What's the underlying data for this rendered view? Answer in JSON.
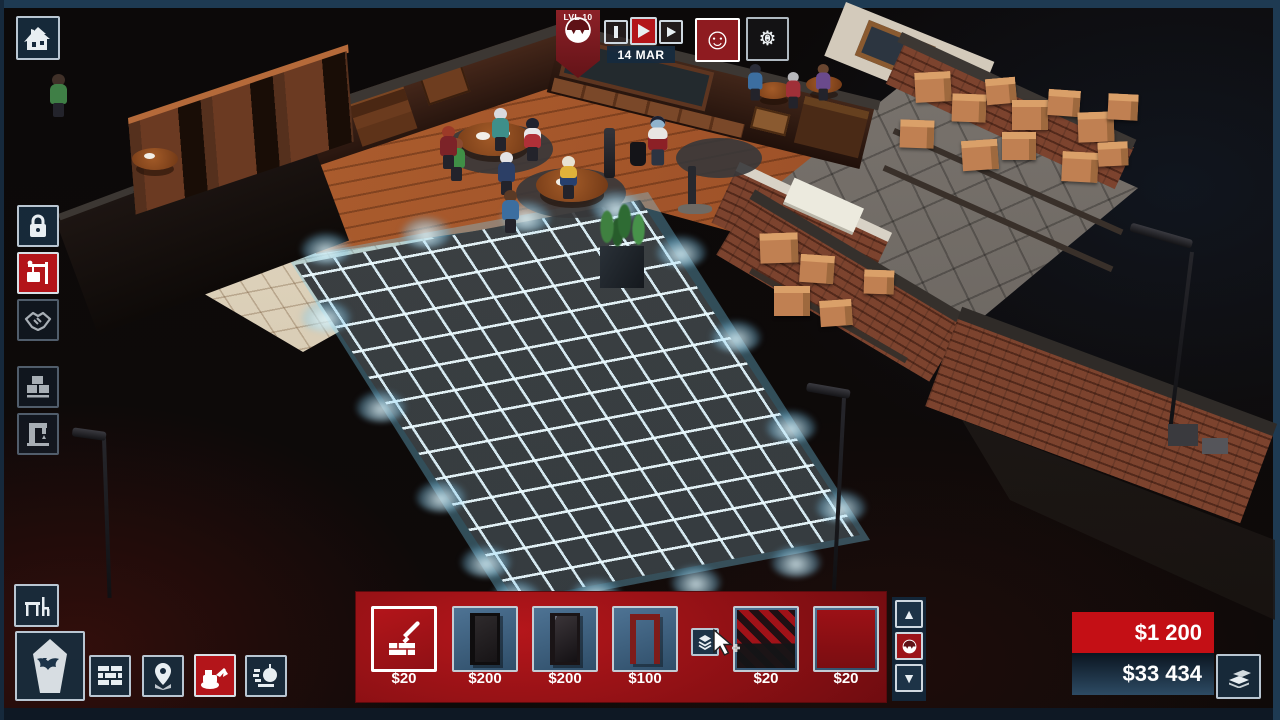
{
  "hud": {
    "level_badge": {
      "label": "LVL 10",
      "icon": "vampire-face-icon"
    },
    "playback": {
      "active": "play",
      "buttons": [
        "pause",
        "play",
        "fast-forward"
      ]
    },
    "date": "14 MAR",
    "mood": {
      "glyph": "☺",
      "icon": "smiley-icon"
    },
    "maintenance": {
      "glyph": "⚙",
      "count": "0",
      "icon": "gear-icon"
    }
  },
  "left_toolbar": {
    "items": [
      {
        "name": "property",
        "icon": "haunted-house-icon"
      },
      {
        "name": "security",
        "icon": "padlock-icon"
      },
      {
        "name": "build",
        "icon": "crane-sign-icon",
        "selected": true
      },
      {
        "name": "deals",
        "icon": "handshake-icon",
        "disabled": true
      },
      {
        "name": "warehouse",
        "icon": "pallet-boxes-icon",
        "disabled": true
      },
      {
        "name": "machines",
        "icon": "drill-press-icon",
        "disabled": true
      }
    ]
  },
  "bottom_toolbar": {
    "items": [
      {
        "name": "furniture",
        "icon": "table-chair-icon"
      },
      {
        "name": "coffin",
        "icon": "coffin-bat-icon"
      },
      {
        "name": "walls",
        "icon": "brick-wall-icon"
      },
      {
        "name": "locations",
        "icon": "map-pin-icon"
      },
      {
        "name": "excavate",
        "icon": "excavator-icon",
        "selected": true
      },
      {
        "name": "demolish",
        "icon": "wrecking-ball-icon"
      }
    ]
  },
  "build_palette": {
    "items": [
      {
        "label": "floor-build-tool",
        "icon": "trowel-bricks-icon",
        "price": "$20",
        "selected": true
      },
      {
        "label": "dark-door",
        "price": "$200"
      },
      {
        "label": "glass-display-door",
        "price": "$200"
      },
      {
        "label": "door-frame",
        "price": "$100"
      },
      {
        "label": "checkered-flooring",
        "price": "$20"
      },
      {
        "label": "red-flooring",
        "price": "$20"
      }
    ],
    "variants_button": {
      "icon": "layers-icon"
    },
    "scroll": {
      "up_glyph": "▲",
      "down_glyph": "▼",
      "category_icon": "vampire-face-icon"
    }
  },
  "finance": {
    "expense": "$1 200",
    "balance": "$33 434",
    "cash_icon": "money-stack-icon"
  },
  "colors": {
    "accent_red": "#b3151a",
    "money_red": "#c40f15",
    "panel_red": "#8c1014",
    "navy_button": "#1d3347",
    "border_light": "#c3ccd4",
    "frame_blue": "#1e3a52",
    "grid_glow": "#bfeeff",
    "wood_floor": "#a3552a",
    "brick": "#7c432e"
  }
}
